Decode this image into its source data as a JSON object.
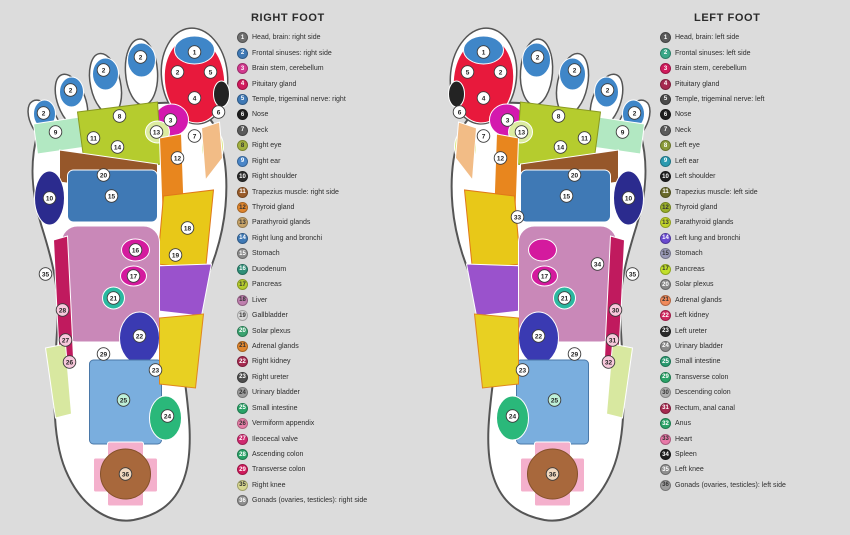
{
  "background": "#dcdcdc",
  "right_panel": {
    "title": "RIGHT FOOT",
    "legend": [
      {
        "num": 1,
        "color": "#6e6e6e",
        "label": "Head, brain: right side"
      },
      {
        "num": 2,
        "color": "#3f79b5",
        "label": "Frontal sinuses: right side"
      },
      {
        "num": 3,
        "color": "#d23a8e",
        "label": "Brain stem, cerebellum"
      },
      {
        "num": 4,
        "color": "#d01a5c",
        "label": "Pituitary gland"
      },
      {
        "num": 5,
        "color": "#3f79b5",
        "label": "Temple, trigeminal nerve: right"
      },
      {
        "num": 6,
        "color": "#1f1f1f",
        "label": "Nose"
      },
      {
        "num": 7,
        "color": "#5a5a5a",
        "label": "Neck"
      },
      {
        "num": 8,
        "color": "#a3b13f",
        "label": "Right eye"
      },
      {
        "num": 9,
        "color": "#4a86c8",
        "label": "Right ear"
      },
      {
        "num": 10,
        "color": "#2a2a2a",
        "label": "Right shoulder"
      },
      {
        "num": 11,
        "color": "#9a5c2a",
        "label": "Trapezius muscle: right side"
      },
      {
        "num": 12,
        "color": "#e0862e",
        "label": "Thyroid gland"
      },
      {
        "num": 13,
        "color": "#c8a468",
        "label": "Parathyroid glands"
      },
      {
        "num": 14,
        "color": "#3f79b5",
        "label": "Right lung and bronchi"
      },
      {
        "num": 15,
        "color": "#8c8c8c",
        "label": "Stomach"
      },
      {
        "num": 16,
        "color": "#2f8f78",
        "label": "Duodenum"
      },
      {
        "num": 17,
        "color": "#b5cc2e",
        "label": "Pancreas"
      },
      {
        "num": 18,
        "color": "#bf7fae",
        "label": "Liver"
      },
      {
        "num": 19,
        "color": "#d8d8d8",
        "label": "Gallbladder"
      },
      {
        "num": 20,
        "color": "#3aa370",
        "label": "Solar plexus"
      },
      {
        "num": 21,
        "color": "#e0862e",
        "label": "Adrenal glands"
      },
      {
        "num": 22,
        "color": "#a62a50",
        "label": "Right kidney"
      },
      {
        "num": 23,
        "color": "#4f4f4f",
        "label": "Right ureter"
      },
      {
        "num": 24,
        "color": "#9e9e9e",
        "label": "Urinary bladder"
      },
      {
        "num": 25,
        "color": "#2aa368",
        "label": "Small intestine"
      },
      {
        "num": 26,
        "color": "#e87fa8",
        "label": "Vermiform appendix"
      },
      {
        "num": 27,
        "color": "#d02a70",
        "label": "Ileocecal valve"
      },
      {
        "num": 28,
        "color": "#2aa368",
        "label": "Ascending colon"
      },
      {
        "num": 29,
        "color": "#d01a5c",
        "label": "Transverse colon"
      },
      {
        "num": 35,
        "color": "#d8d890",
        "label": "Right knee"
      },
      {
        "num": 36,
        "color": "#8f8f8f",
        "label": "Gonads (ovaries, testicles): right side"
      }
    ]
  },
  "left_panel": {
    "title": "LEFT FOOT",
    "legend": [
      {
        "num": 1,
        "color": "#5a5a5a",
        "label": "Head, brain: left side"
      },
      {
        "num": 2,
        "color": "#3aa888",
        "label": "Frontal sinuses: left side"
      },
      {
        "num": 3,
        "color": "#d01a5c",
        "label": "Brain stem, cerebellum"
      },
      {
        "num": 4,
        "color": "#a62a50",
        "label": "Pituitary gland"
      },
      {
        "num": 5,
        "color": "#4a4a4a",
        "label": "Temple, trigeminal nerve: left"
      },
      {
        "num": 6,
        "color": "#1f1f1f",
        "label": "Nose"
      },
      {
        "num": 7,
        "color": "#5a5a5a",
        "label": "Neck"
      },
      {
        "num": 8,
        "color": "#8a9a3a",
        "label": "Left eye"
      },
      {
        "num": 9,
        "color": "#2a9ab0",
        "label": "Left ear"
      },
      {
        "num": 10,
        "color": "#1f1f1f",
        "label": "Left shoulder"
      },
      {
        "num": 11,
        "color": "#6a6a2a",
        "label": "Trapezius muscle: left side"
      },
      {
        "num": 12,
        "color": "#9ab02a",
        "label": "Thyroid gland"
      },
      {
        "num": 13,
        "color": "#c2d42a",
        "label": "Parathyroid glands"
      },
      {
        "num": 14,
        "color": "#6a4ad0",
        "label": "Left lung and bronchi"
      },
      {
        "num": 15,
        "color": "#9a9ab8",
        "label": "Stomach"
      },
      {
        "num": 17,
        "color": "#c2e02a",
        "label": "Pancreas"
      },
      {
        "num": 20,
        "color": "#8a8a8a",
        "label": "Solar plexus"
      },
      {
        "num": 21,
        "color": "#f08a5a",
        "label": "Adrenal glands"
      },
      {
        "num": 22,
        "color": "#d02a60",
        "label": "Left kidney"
      },
      {
        "num": 23,
        "color": "#2a2a2a",
        "label": "Left ureter"
      },
      {
        "num": 24,
        "color": "#8a8a8a",
        "label": "Urinary bladder"
      },
      {
        "num": 25,
        "color": "#2a9a70",
        "label": "Small intestine"
      },
      {
        "num": 29,
        "color": "#2aa368",
        "label": "Transverse colon"
      },
      {
        "num": 30,
        "color": "#b0b0b0",
        "label": "Descending colon"
      },
      {
        "num": 31,
        "color": "#a62a50",
        "label": "Rectum, anal canal"
      },
      {
        "num": 32,
        "color": "#2aa368",
        "label": "Anus"
      },
      {
        "num": 33,
        "color": "#e878a8",
        "label": "Heart"
      },
      {
        "num": 34,
        "color": "#1f1f1f",
        "label": "Spleen"
      },
      {
        "num": 35,
        "color": "#8f8f8f",
        "label": "Left knee"
      },
      {
        "num": 36,
        "color": "#9e9e9e",
        "label": "Gonads (ovaries, testicles): left side"
      }
    ]
  },
  "foot_art": {
    "viewbox": "0 0 225 512",
    "outline_fill": "#ffffff",
    "outline_stroke": "#555555",
    "sole_path": "M 30 122 C 22 150 24 182 34 214 C 44 246 52 274 50 312 C 47 362 42 420 58 458 C 74 496 102 512 126 508 C 152 503 170 490 178 462 C 186 434 181 398 177 366 C 173 336 179 308 191 284 C 204 257 215 228 218 194 C 221 160 216 132 207 114 C 196 93 170 88 140 92 C 100 97 55 108 30 122 Z",
    "toes": [
      {
        "cx": 187,
        "cy": 64,
        "rx": 33,
        "ry": 48,
        "rot": -6
      },
      {
        "cx": 134,
        "cy": 60,
        "rx": 16,
        "ry": 33,
        "rot": -4
      },
      {
        "cx": 98,
        "cy": 72,
        "rx": 15,
        "ry": 31,
        "rot": -12
      },
      {
        "cx": 64,
        "cy": 89,
        "rx": 14,
        "ry": 28,
        "rot": -20
      },
      {
        "cx": 37,
        "cy": 110,
        "rx": 13,
        "ry": 24,
        "rot": -30
      }
    ],
    "zones": [
      {
        "t": "e",
        "cx": 187,
        "cy": 68,
        "rx": 30,
        "ry": 43,
        "rot": -6,
        "f": "#e8193c"
      },
      {
        "t": "e",
        "cx": 187,
        "cy": 38,
        "rx": 20,
        "ry": 14,
        "f": "#3f86c8"
      },
      {
        "t": "e",
        "cx": 164,
        "cy": 108,
        "rx": 17,
        "ry": 16,
        "f": "#d419ae"
      },
      {
        "t": "e",
        "cx": 214,
        "cy": 82,
        "rx": 8,
        "ry": 13,
        "f": "#232323"
      },
      {
        "t": "e",
        "cx": 134,
        "cy": 48,
        "rx": 14,
        "ry": 17,
        "f": "#3f86c8"
      },
      {
        "t": "e",
        "cx": 98,
        "cy": 62,
        "rx": 13,
        "ry": 16,
        "f": "#3f86c8"
      },
      {
        "t": "e",
        "cx": 64,
        "cy": 80,
        "rx": 12,
        "ry": 15,
        "f": "#3f86c8"
      },
      {
        "t": "e",
        "cx": 37,
        "cy": 102,
        "rx": 11,
        "ry": 14,
        "f": "#3f86c8"
      },
      {
        "t": "p",
        "pts": "26,112 132,96 140,126 30,142",
        "f": "#b2e8c2"
      },
      {
        "t": "p",
        "pts": "70,100 150,90 154,152 78,160",
        "f": "#b5cc2e",
        "s": "#8a9a20"
      },
      {
        "t": "e",
        "cx": 150,
        "cy": 120,
        "rx": 12,
        "ry": 11,
        "f": "#dceca0"
      },
      {
        "t": "e",
        "cx": 205,
        "cy": 135,
        "rx": 11,
        "ry": 17,
        "f": "#d8e882"
      },
      {
        "t": "p",
        "pts": "194,116 212,110 215,146 198,168",
        "f": "#f2bc86"
      },
      {
        "t": "p",
        "pts": "52,138 150,152 150,184 52,170",
        "f": "#96572a"
      },
      {
        "t": "p",
        "pts": "152,126 174,122 178,236 156,240",
        "f": "#e8861e"
      },
      {
        "t": "e",
        "cx": 42,
        "cy": 186,
        "rx": 15,
        "ry": 27,
        "f": "#2b2b8e"
      },
      {
        "t": "r",
        "x": 60,
        "y": 158,
        "w": 90,
        "h": 52,
        "r": 6,
        "f": "#3f79b5"
      },
      {
        "t": "p",
        "pts": "156,184 206,178 198,258 150,252",
        "f": "#e8c818",
        "s": "#e07818"
      },
      {
        "t": "p",
        "pts": "146,254 204,252 194,304 142,298",
        "f": "#9a52cc"
      },
      {
        "t": "r",
        "x": 54,
        "y": 214,
        "w": 98,
        "h": 116,
        "r": 16,
        "f": "#c988b8"
      },
      {
        "t": "p",
        "pts": "46,228 60,224 66,346 52,350",
        "f": "#c01a5e"
      },
      {
        "t": "e",
        "cx": 128,
        "cy": 238,
        "rx": 14,
        "ry": 11,
        "f": "#d41a9e"
      },
      {
        "t": "e",
        "cx": 126,
        "cy": 264,
        "rx": 13,
        "ry": 10,
        "f": "#d41a9e"
      },
      {
        "t": "e",
        "cx": 106,
        "cy": 286,
        "rx": 11,
        "ry": 11,
        "f": "#2ab8a0"
      },
      {
        "t": "e",
        "cx": 132,
        "cy": 326,
        "rx": 20,
        "ry": 26,
        "f": "#3a3ab2"
      },
      {
        "t": "r",
        "x": 82,
        "y": 348,
        "w": 72,
        "h": 84,
        "r": 4,
        "f": "#7aaede",
        "s": "#4a78a8"
      },
      {
        "t": "e",
        "cx": 158,
        "cy": 406,
        "rx": 16,
        "ry": 22,
        "f": "#2ab87a"
      },
      {
        "t": "p",
        "pts": "38,336 58,332 64,402 48,406",
        "f": "#d8e8a0"
      },
      {
        "t": "p",
        "pts": "152,306 196,302 188,376 152,372",
        "f": "#e8d022",
        "s": "#e0861e"
      },
      {
        "t": "r",
        "x": 86,
        "y": 446,
        "w": 64,
        "h": 34,
        "r": 2,
        "f": "#f4b0cc"
      },
      {
        "t": "r",
        "x": 100,
        "y": 430,
        "w": 36,
        "h": 64,
        "r": 2,
        "f": "#f4b0cc"
      },
      {
        "t": "e",
        "cx": 118,
        "cy": 462,
        "rx": 25,
        "ry": 25,
        "f": "#a8683c",
        "s": "#84512a"
      }
    ]
  },
  "right_foot": {
    "mirror": false,
    "markers": [
      {
        "n": "1",
        "x": 187,
        "y": 40
      },
      {
        "n": "2",
        "x": 170,
        "y": 60
      },
      {
        "n": "5",
        "x": 203,
        "y": 60
      },
      {
        "n": "4",
        "x": 187,
        "y": 86
      },
      {
        "n": "3",
        "x": 163,
        "y": 108
      },
      {
        "n": "6",
        "x": 211,
        "y": 100
      },
      {
        "n": "7",
        "x": 187,
        "y": 124
      },
      {
        "n": "2",
        "x": 133,
        "y": 45
      },
      {
        "n": "2",
        "x": 96,
        "y": 58
      },
      {
        "n": "2",
        "x": 63,
        "y": 78
      },
      {
        "n": "2",
        "x": 36,
        "y": 101
      },
      {
        "n": "8",
        "x": 112,
        "y": 104
      },
      {
        "n": "9",
        "x": 48,
        "y": 120
      },
      {
        "n": "11",
        "x": 86,
        "y": 126
      },
      {
        "n": "13",
        "x": 149,
        "y": 120
      },
      {
        "n": "12",
        "x": 170,
        "y": 146
      },
      {
        "n": "14",
        "x": 110,
        "y": 135
      },
      {
        "n": "20",
        "x": 96,
        "y": 163
      },
      {
        "n": "10",
        "x": 42,
        "y": 186
      },
      {
        "n": "15",
        "x": 104,
        "y": 184
      },
      {
        "n": "16",
        "x": 128,
        "y": 238
      },
      {
        "n": "17",
        "x": 126,
        "y": 264
      },
      {
        "n": "18",
        "x": 180,
        "y": 216
      },
      {
        "n": "19",
        "x": 168,
        "y": 243
      },
      {
        "n": "21",
        "x": 106,
        "y": 286
      },
      {
        "n": "22",
        "x": 132,
        "y": 324
      },
      {
        "n": "23",
        "x": 148,
        "y": 358
      },
      {
        "n": "24",
        "x": 160,
        "y": 404
      },
      {
        "n": "25",
        "x": 116,
        "y": 388,
        "f": "#bff0d8"
      },
      {
        "n": "26",
        "x": 62,
        "y": 350,
        "f": "#f8c8dc"
      },
      {
        "n": "27",
        "x": 58,
        "y": 328,
        "f": "#f8c8dc"
      },
      {
        "n": "28",
        "x": 55,
        "y": 298,
        "f": "#f8c8dc"
      },
      {
        "n": "29",
        "x": 96,
        "y": 342
      },
      {
        "n": "35",
        "x": 38,
        "y": 262
      },
      {
        "n": "36",
        "x": 118,
        "y": 462,
        "f": "#f0d8c0"
      }
    ]
  },
  "left_foot": {
    "mirror": true,
    "markers": [
      {
        "n": "1",
        "x": 38,
        "y": 40
      },
      {
        "n": "2",
        "x": 55,
        "y": 60
      },
      {
        "n": "5",
        "x": 22,
        "y": 60
      },
      {
        "n": "4",
        "x": 38,
        "y": 86
      },
      {
        "n": "3",
        "x": 62,
        "y": 108
      },
      {
        "n": "6",
        "x": 14,
        "y": 100
      },
      {
        "n": "7",
        "x": 38,
        "y": 124
      },
      {
        "n": "2",
        "x": 92,
        "y": 45
      },
      {
        "n": "2",
        "x": 129,
        "y": 58
      },
      {
        "n": "2",
        "x": 162,
        "y": 78
      },
      {
        "n": "2",
        "x": 189,
        "y": 101
      },
      {
        "n": "8",
        "x": 113,
        "y": 104
      },
      {
        "n": "9",
        "x": 177,
        "y": 120
      },
      {
        "n": "11",
        "x": 139,
        "y": 126
      },
      {
        "n": "13",
        "x": 76,
        "y": 120
      },
      {
        "n": "12",
        "x": 55,
        "y": 146
      },
      {
        "n": "14",
        "x": 115,
        "y": 135
      },
      {
        "n": "20",
        "x": 129,
        "y": 163
      },
      {
        "n": "10",
        "x": 183,
        "y": 186
      },
      {
        "n": "15",
        "x": 121,
        "y": 184
      },
      {
        "n": "17",
        "x": 99,
        "y": 264
      },
      {
        "n": "33",
        "x": 72,
        "y": 205
      },
      {
        "n": "34",
        "x": 152,
        "y": 252
      },
      {
        "n": "21",
        "x": 119,
        "y": 286
      },
      {
        "n": "22",
        "x": 93,
        "y": 324
      },
      {
        "n": "23",
        "x": 77,
        "y": 358
      },
      {
        "n": "24",
        "x": 67,
        "y": 404
      },
      {
        "n": "25",
        "x": 109,
        "y": 388,
        "f": "#bff0d8"
      },
      {
        "n": "29",
        "x": 129,
        "y": 342
      },
      {
        "n": "30",
        "x": 170,
        "y": 298,
        "f": "#f8c8dc"
      },
      {
        "n": "31",
        "x": 167,
        "y": 328,
        "f": "#f8c8dc"
      },
      {
        "n": "32",
        "x": 163,
        "y": 350,
        "f": "#f8c8dc"
      },
      {
        "n": "35",
        "x": 187,
        "y": 262
      },
      {
        "n": "36",
        "x": 107,
        "y": 462,
        "f": "#f0d8c0"
      }
    ]
  }
}
